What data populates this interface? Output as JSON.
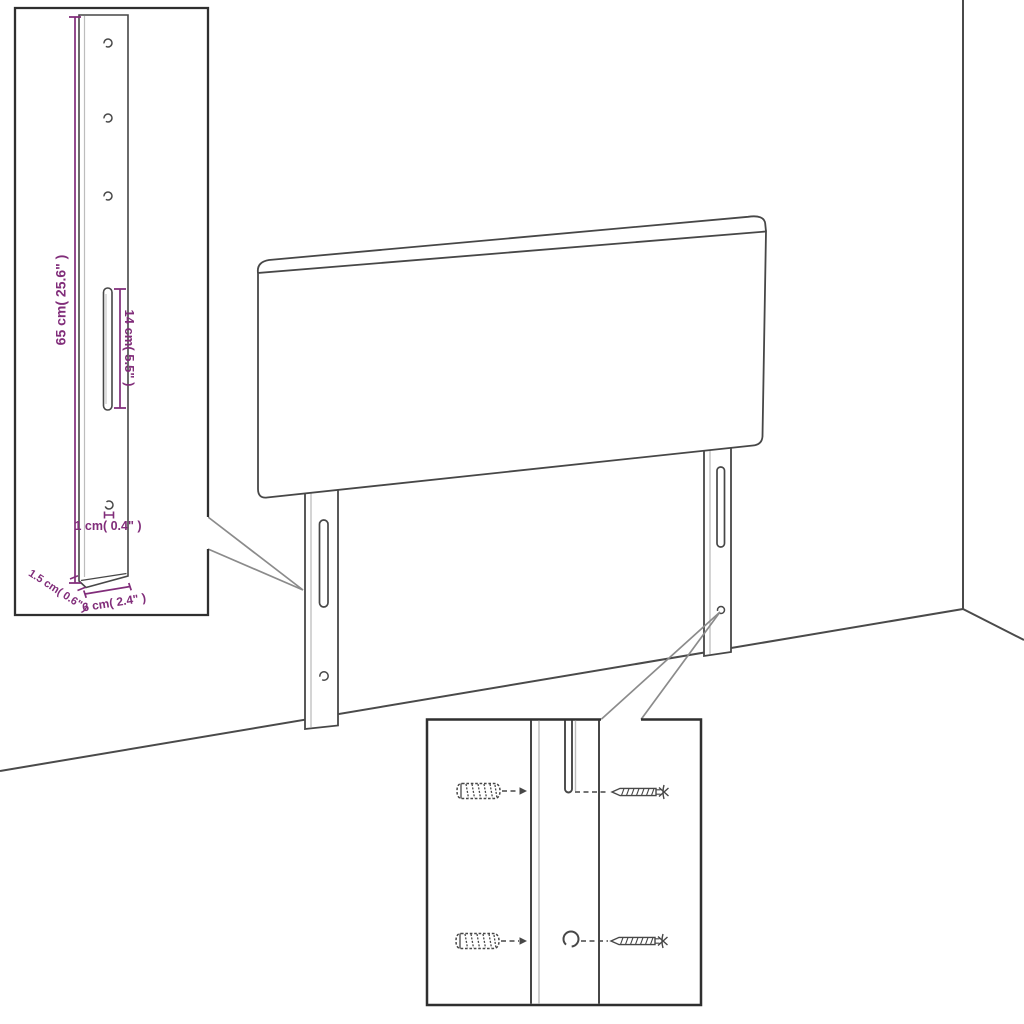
{
  "colors": {
    "outline": "#474747",
    "soft_line": "#bdbdbd",
    "dimension": "#812d7a",
    "callout": "#8b8b8b"
  },
  "leg_inset": {
    "height": "65 cm( 25.6\" )",
    "slot_length": "14 cm( 5.5\" )",
    "hole_diameter": "1 cm( 0.4\" )",
    "thickness": "1.5 cm( 0.6\" )",
    "width": "6 cm( 2.4\" )"
  }
}
